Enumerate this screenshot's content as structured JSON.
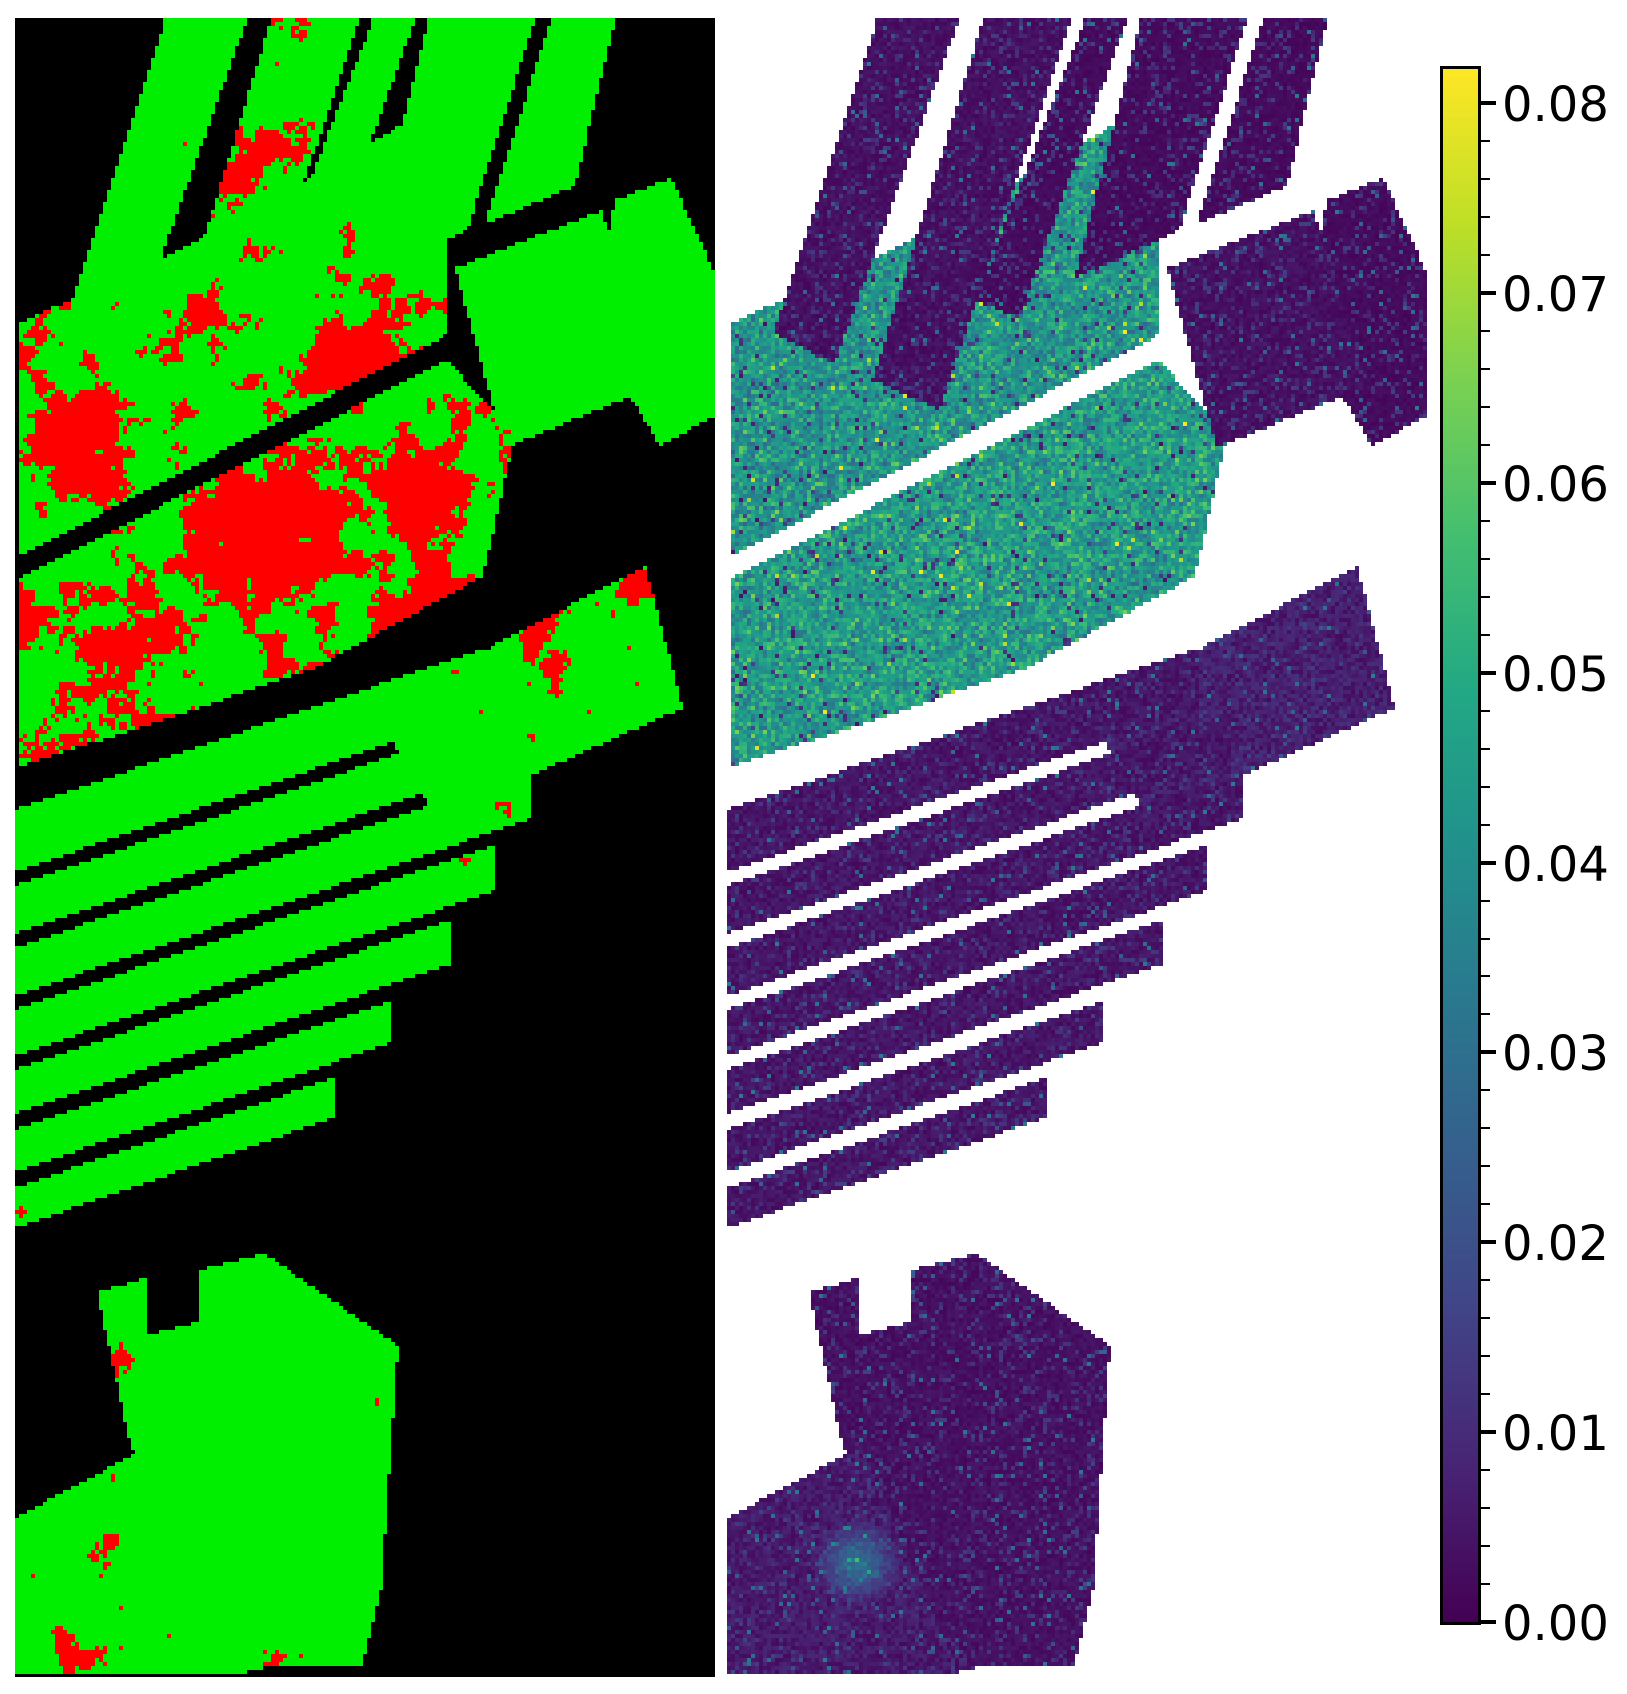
{
  "figure": {
    "width": 1627,
    "height": 1694,
    "background": "#ffffff"
  },
  "chart_data": {
    "type": "heatmap",
    "title": "",
    "panels": [
      {
        "id": "classification-map",
        "x": 15,
        "y": 18,
        "width": 700,
        "height": 1659,
        "background": "#000000",
        "classes": [
          {
            "name": "correctly-classified",
            "color": "#00ef00"
          },
          {
            "name": "misclassified",
            "color": "#ff0000"
          },
          {
            "name": "unlabeled-background",
            "color": "#000000"
          }
        ]
      },
      {
        "id": "error-map",
        "x": 727,
        "y": 18,
        "width": 700,
        "height": 1659,
        "background": "#ffffff",
        "colormap": "viridis",
        "value_range": [
          0.0,
          0.0818
        ]
      }
    ],
    "colorbar": {
      "x": 1443,
      "y": 69,
      "width": 35,
      "height": 1553,
      "vmin": 0.0,
      "vmax": 0.0818,
      "major_ticks": [
        {
          "value": 0.0,
          "label": "0.00"
        },
        {
          "value": 0.01,
          "label": "0.01"
        },
        {
          "value": 0.02,
          "label": "0.02"
        },
        {
          "value": 0.03,
          "label": "0.03"
        },
        {
          "value": 0.04,
          "label": "0.04"
        },
        {
          "value": 0.05,
          "label": "0.05"
        },
        {
          "value": 0.06,
          "label": "0.06"
        },
        {
          "value": 0.07,
          "label": "0.07"
        },
        {
          "value": 0.08,
          "label": "0.08"
        }
      ],
      "minor_tick_interval": 0.002,
      "label_font_px": 48,
      "tick_color": "#000000",
      "label_color": "#000000"
    },
    "colormap_stops": [
      {
        "t": 0.0,
        "c": "#440154"
      },
      {
        "t": 0.1,
        "c": "#482475"
      },
      {
        "t": 0.2,
        "c": "#414487"
      },
      {
        "t": 0.3,
        "c": "#355f8d"
      },
      {
        "t": 0.4,
        "c": "#2a788e"
      },
      {
        "t": 0.5,
        "c": "#21918c"
      },
      {
        "t": 0.6,
        "c": "#22a884"
      },
      {
        "t": 0.7,
        "c": "#44bf70"
      },
      {
        "t": 0.8,
        "c": "#7ad151"
      },
      {
        "t": 0.9,
        "c": "#bddf26"
      },
      {
        "t": 1.0,
        "c": "#fde725"
      }
    ],
    "render": {
      "pixel_block": 4,
      "seed": 1337
    },
    "fields": [
      {
        "id": "top-strip-1",
        "poly": [
          [
            150,
            2
          ],
          [
            232,
            2
          ],
          [
            108,
            345
          ],
          [
            46,
            315
          ]
        ],
        "error_rate": 0.12,
        "value": 0.003,
        "red_hotspots": [
          [
            95,
            290,
            40,
            0.5
          ]
        ],
        "teal_spots": []
      },
      {
        "id": "top-strip-2",
        "poly": [
          [
            256,
            2
          ],
          [
            344,
            2
          ],
          [
            212,
            392
          ],
          [
            146,
            362
          ]
        ],
        "error_rate": 0.3,
        "value": 0.003,
        "red_hotspots": [
          [
            235,
            140,
            55,
            0.45
          ],
          [
            185,
            300,
            55,
            0.5
          ]
        ],
        "teal_spots": []
      },
      {
        "id": "grid-col-0",
        "poly": [
          [
            358,
            2
          ],
          [
            400,
            2
          ],
          [
            292,
            300
          ],
          [
            248,
            282
          ]
        ],
        "error_rate": 0.05,
        "value": 0.002,
        "red_hotspots": [],
        "teal_spots": []
      },
      {
        "id": "grid-col-1",
        "poly": [
          [
            414,
            2
          ],
          [
            520,
            2
          ],
          [
            452,
            213
          ],
          [
            348,
            260
          ]
        ],
        "error_rate": 0.04,
        "value": 0.002,
        "red_hotspots": [],
        "teal_spots": []
      },
      {
        "id": "grid-col-2",
        "poly": [
          [
            536,
            2
          ],
          [
            600,
            2
          ],
          [
            560,
            168
          ],
          [
            470,
            206
          ]
        ],
        "error_rate": 0.04,
        "value": 0.002,
        "red_hotspots": [],
        "teal_spots": []
      },
      {
        "id": "grid-row2-mid",
        "poly": [
          [
            440,
            250
          ],
          [
            586,
            193
          ],
          [
            640,
            368
          ],
          [
            490,
            430
          ]
        ],
        "error_rate": 0.06,
        "value": 0.003,
        "red_hotspots": [
          [
            510,
            410,
            40,
            0.35
          ]
        ],
        "teal_spots": []
      },
      {
        "id": "grid-right-edge",
        "poly": [
          [
            600,
            182
          ],
          [
            656,
            160
          ],
          [
            700,
            255
          ],
          [
            700,
            398
          ],
          [
            645,
            428
          ],
          [
            575,
            310
          ]
        ],
        "error_rate": 0.06,
        "value": 0.002,
        "red_hotspots": [
          [
            630,
            425,
            40,
            0.35
          ]
        ],
        "teal_spots": []
      },
      {
        "id": "big-field-upper",
        "poly": [
          [
            5,
            305
          ],
          [
            200,
            215
          ],
          [
            420,
            88
          ],
          [
            435,
            150
          ],
          [
            430,
            318
          ],
          [
            5,
            538
          ]
        ],
        "error_rate": 0.32,
        "value": 0.041,
        "red_hotspots": [
          [
            60,
            420,
            90,
            0.5
          ],
          [
            350,
            330,
            85,
            0.55
          ],
          [
            200,
            300,
            70,
            0.3
          ],
          [
            390,
            180,
            40,
            0.3
          ],
          [
            10,
            330,
            40,
            0.45
          ]
        ],
        "teal_spots": []
      },
      {
        "id": "big-field-lower",
        "poly": [
          [
            5,
            560
          ],
          [
            432,
            342
          ],
          [
            500,
            418
          ],
          [
            468,
            558
          ],
          [
            300,
            650
          ],
          [
            130,
            708
          ],
          [
            5,
            748
          ]
        ],
        "error_rate": 0.42,
        "value": 0.043,
        "red_hotspots": [
          [
            250,
            520,
            110,
            0.55
          ],
          [
            110,
            630,
            70,
            0.5
          ],
          [
            390,
            470,
            80,
            0.5
          ],
          [
            420,
            590,
            70,
            0.6
          ],
          [
            10,
            600,
            40,
            0.5
          ]
        ],
        "teal_spots": []
      },
      {
        "id": "fan-strip-1",
        "poly": [
          [
            0,
            792
          ],
          [
            473,
            629
          ],
          [
            473,
            691
          ],
          [
            0,
            854
          ]
        ],
        "error_rate": 0.07,
        "value": 0.004,
        "red_hotspots": [
          [
            430,
            660,
            35,
            0.4
          ]
        ],
        "teal_spots": []
      },
      {
        "id": "fan-strip-2",
        "poly": [
          [
            0,
            868
          ],
          [
            501,
            695
          ],
          [
            501,
            743
          ],
          [
            0,
            916
          ]
        ],
        "error_rate": 0.06,
        "value": 0.004,
        "red_hotspots": [],
        "teal_spots": []
      },
      {
        "id": "fan-strip-3",
        "poly": [
          [
            0,
            930
          ],
          [
            515,
            753
          ],
          [
            515,
            801
          ],
          [
            0,
            978
          ]
        ],
        "error_rate": 0.07,
        "value": 0.004,
        "red_hotspots": [
          [
            8,
            950,
            25,
            0.4
          ],
          [
            480,
            790,
            30,
            0.4
          ]
        ],
        "teal_spots": []
      },
      {
        "id": "fan-strip-4",
        "poly": [
          [
            0,
            992
          ],
          [
            482,
            826
          ],
          [
            482,
            872
          ],
          [
            0,
            1038
          ]
        ],
        "error_rate": 0.07,
        "value": 0.004,
        "red_hotspots": [
          [
            450,
            845,
            30,
            0.45
          ]
        ],
        "teal_spots": []
      },
      {
        "id": "fan-strip-5",
        "poly": [
          [
            0,
            1052
          ],
          [
            435,
            902
          ],
          [
            435,
            946
          ],
          [
            0,
            1096
          ]
        ],
        "error_rate": 0.07,
        "value": 0.004,
        "red_hotspots": [
          [
            410,
            925,
            28,
            0.4
          ]
        ],
        "teal_spots": []
      },
      {
        "id": "fan-strip-6",
        "poly": [
          [
            0,
            1112
          ],
          [
            378,
            982
          ],
          [
            378,
            1024
          ],
          [
            0,
            1154
          ]
        ],
        "error_rate": 0.05,
        "value": 0.004,
        "red_hotspots": [],
        "teal_spots": []
      },
      {
        "id": "fan-strip-7",
        "poly": [
          [
            0,
            1170
          ],
          [
            321,
            1059
          ],
          [
            321,
            1099
          ],
          [
            0,
            1210
          ]
        ],
        "error_rate": 0.06,
        "value": 0.004,
        "red_hotspots": [
          [
            8,
            1195,
            22,
            0.35
          ]
        ],
        "teal_spots": []
      },
      {
        "id": "mid-right-field",
        "poly": [
          [
            360,
            690
          ],
          [
            630,
            548
          ],
          [
            668,
            690
          ],
          [
            420,
            800
          ]
        ],
        "error_rate": 0.2,
        "value": 0.006,
        "red_hotspots": [
          [
            420,
            680,
            55,
            0.55
          ],
          [
            520,
            630,
            60,
            0.5
          ],
          [
            610,
            570,
            50,
            0.45
          ]
        ],
        "teal_spots": []
      },
      {
        "id": "bottom-left-field",
        "poly": [
          [
            0,
            1500
          ],
          [
            135,
            1428
          ],
          [
            165,
            1500
          ],
          [
            232,
            1655
          ],
          [
            0,
            1655
          ]
        ],
        "error_rate": 0.16,
        "value": 0.005,
        "red_hotspots": [
          [
            95,
            1530,
            40,
            0.55
          ],
          [
            60,
            1640,
            50,
            0.4
          ]
        ],
        "teal_spots": [
          [
            130,
            1545,
            45,
            0.027
          ]
        ]
      },
      {
        "id": "bottom-trapezoid",
        "poly": [
          [
            82,
            1275
          ],
          [
            130,
            1260
          ],
          [
            133,
            1317
          ],
          [
            186,
            1303
          ],
          [
            183,
            1252
          ],
          [
            250,
            1236
          ],
          [
            383,
            1328
          ],
          [
            366,
            1572
          ],
          [
            348,
            1646
          ],
          [
            196,
            1652
          ],
          [
            115,
            1425
          ]
        ],
        "error_rate": 0.12,
        "value": 0.003,
        "red_hotspots": [
          [
            105,
            1350,
            35,
            0.45
          ],
          [
            150,
            1590,
            45,
            0.4
          ],
          [
            250,
            1640,
            40,
            0.35
          ],
          [
            370,
            1560,
            25,
            0.3
          ]
        ],
        "teal_spots": []
      }
    ]
  }
}
